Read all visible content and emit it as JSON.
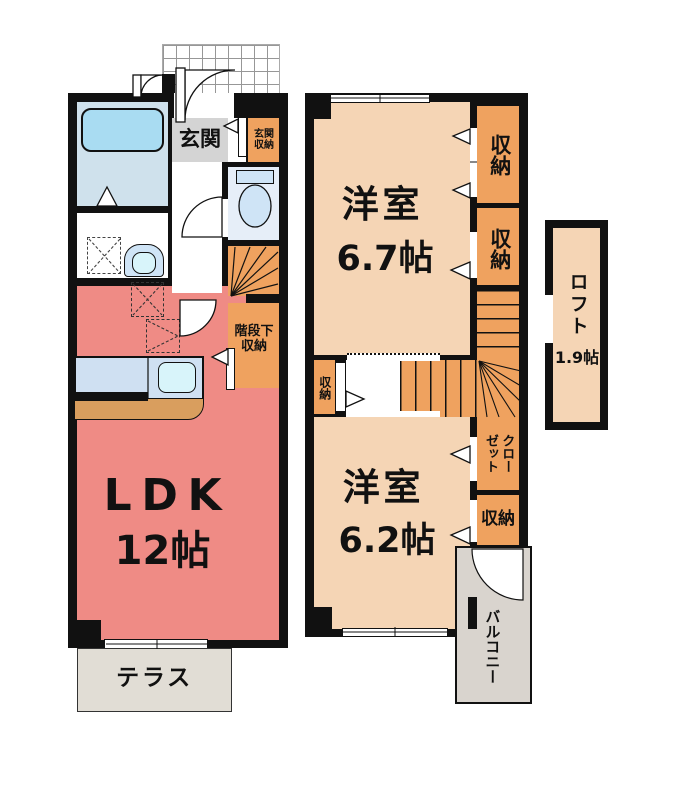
{
  "title": "2-story apartment floor plan",
  "floor1": {
    "genkan": "玄関",
    "genkan_storage": "玄関収納",
    "understairs": "階段下収納",
    "ldk_name": "LDK",
    "ldk_size": "12帖",
    "terrace": "テラス"
  },
  "floor2": {
    "room1_name": "洋室",
    "room1_size": "6.7帖",
    "storage_a": "収納",
    "storage_b": "収納",
    "storage_hall": "収納",
    "closet": "クローゼット",
    "room2_name": "洋室",
    "room2_size": "6.2帖",
    "storage_d": "収納",
    "balcony": "バルコニー"
  },
  "loft": {
    "name": "ロフト",
    "size": "1.9帖"
  },
  "colors": {
    "wall": "#111111",
    "ldk": "#ef8b85",
    "room_peach": "#f5d5b5",
    "storage_orange": "#efa25f",
    "genkan_gray": "#d4d4d4",
    "bath_blue": "#cfe1ec",
    "tub_blue": "#a9dcf2",
    "toilet_blue": "#e6eef8",
    "fixture_blue": "#cfe4f6",
    "counter_blue": "#cfe0f2",
    "sink_blue": "#d8f4fa",
    "counter_brown": "#d99e5e",
    "terrace_gray": "#e1ddd5",
    "balcony_gray": "#d9d4ce",
    "white": "#ffffff"
  }
}
